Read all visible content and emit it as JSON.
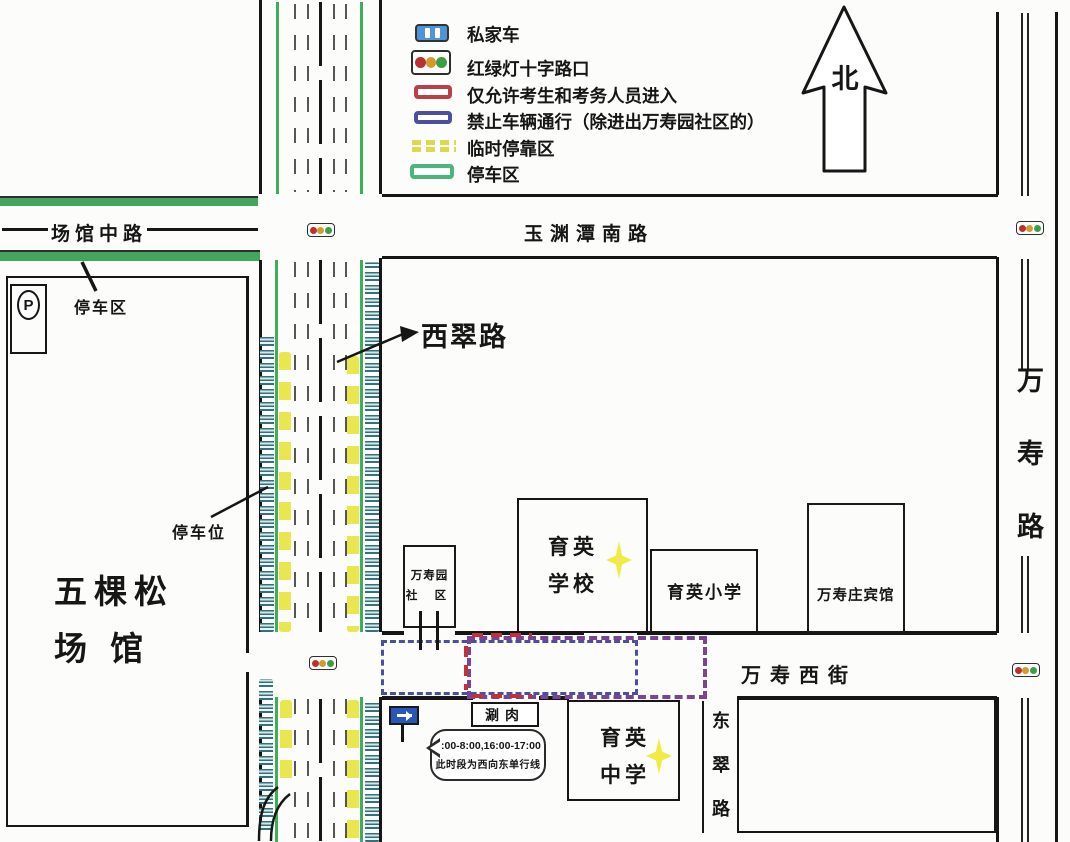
{
  "legend": {
    "private_car": "私家车",
    "traffic_light": "红绿灯十字路口",
    "examinee_only": "仅允许考生和考务人员进入",
    "no_vehicles": "禁止车辆通行（除进出万寿园社区的）",
    "temporary_stop": "临时停靠区",
    "parking_area": "停车区"
  },
  "compass": {
    "north": "北"
  },
  "roads": {
    "changguan_middle": "场馆中路",
    "yuyuantan_south": "玉渊潭南路",
    "xicui": "西翠路",
    "wanshou": "万寿路",
    "wanshou_west": "万寿西街",
    "dongcui": "东翠路"
  },
  "places": {
    "wukesong_line1": "五棵松",
    "wukesong_line2": "场 馆",
    "wanshouyuan_line1": "万寿园",
    "wanshouyuan_line2": "社 区",
    "yuying_school_line1": "育英",
    "yuying_school_line2": "学校",
    "yuying_primary": "育英小学",
    "wanshouzhuang_hotel": "万寿庄宾馆",
    "yuying_middle_line1": "育英",
    "yuying_middle_line2": "中学",
    "shuanrou": "涮肉"
  },
  "annotations": {
    "parking_area": "停车区",
    "parking_spots": "停车位",
    "p_symbol": "P",
    "note_line1": "7:00-8:00,16:00-17:00",
    "note_line2": "此时段为西向东单行线"
  },
  "colors": {
    "parking_green": "#44a55f",
    "temp_stop_yellow": "#e9e74f",
    "examinee_red": "#bb3f49",
    "no_vehicle_blue": "#4a4fa0",
    "overlap_purple": "#7b4394"
  }
}
